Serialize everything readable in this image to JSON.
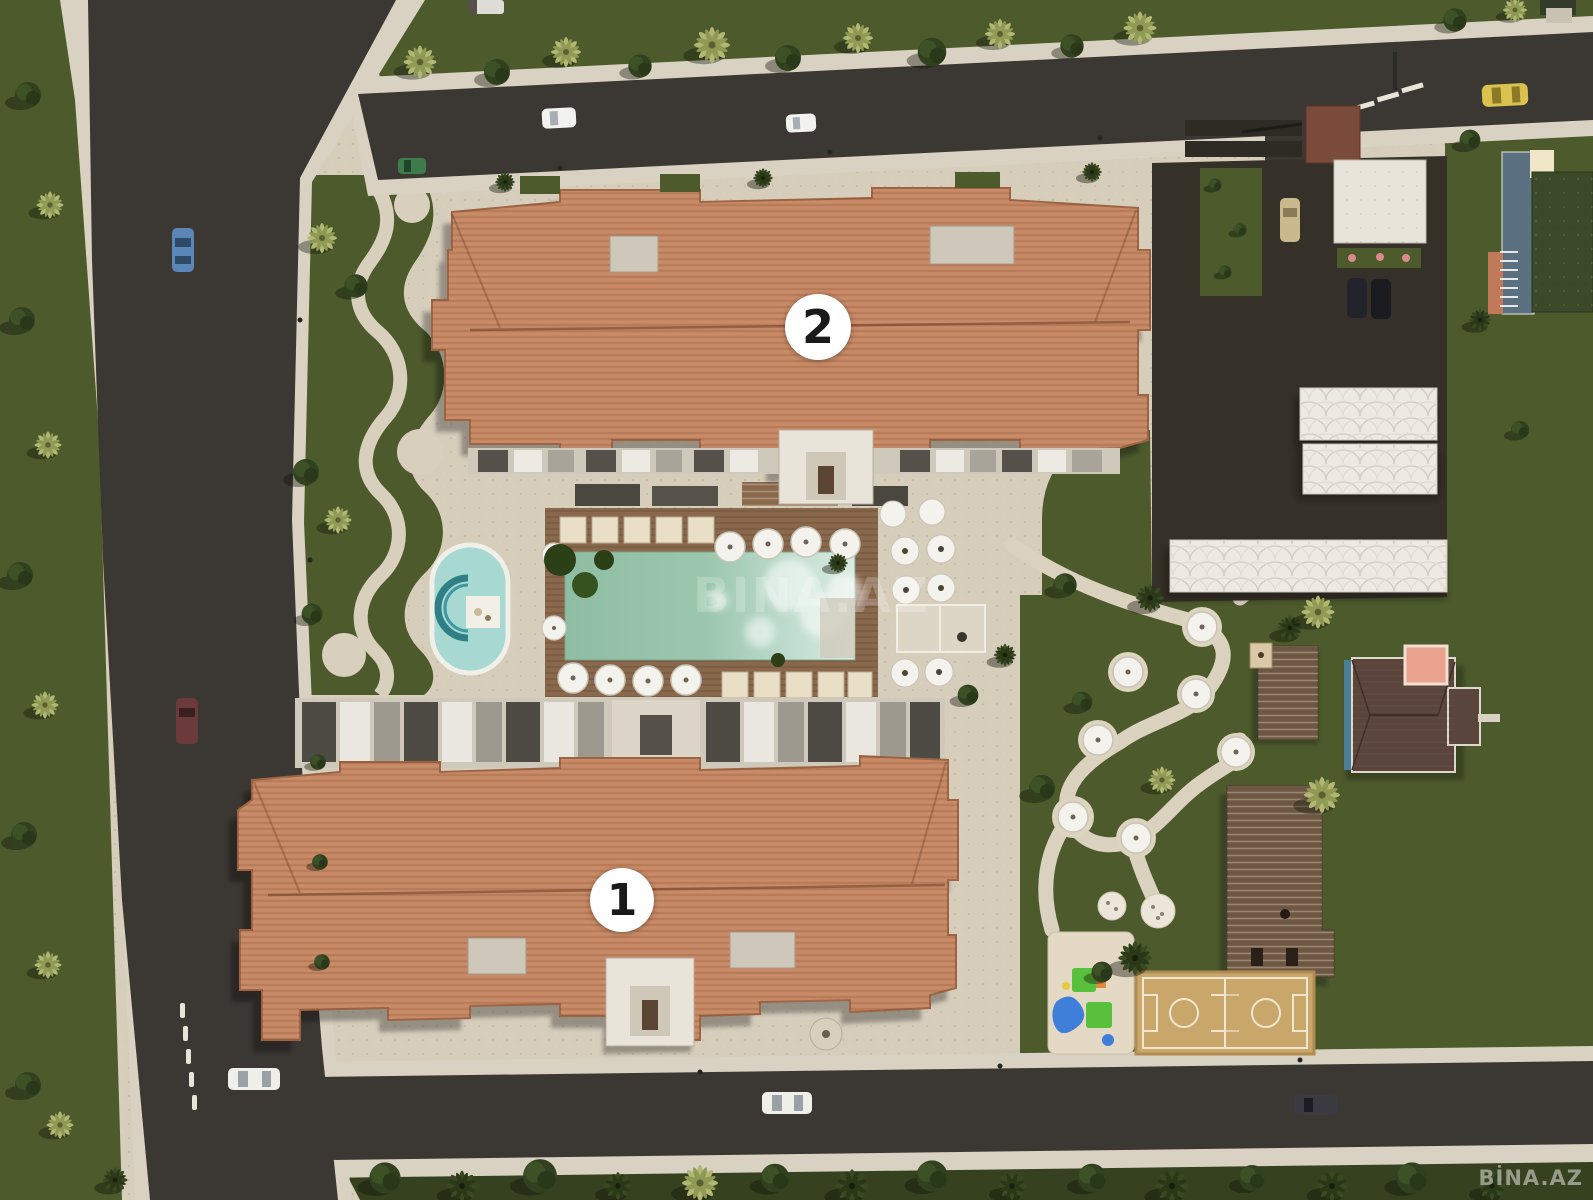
{
  "site_plan": {
    "title": "residential-complex-master-plan",
    "watermark_center": "BINA.AZ",
    "watermark_corner": "BİNA.AZ",
    "buildings": [
      {
        "id": "building-1",
        "label": "1"
      },
      {
        "id": "building-2",
        "label": "2"
      }
    ]
  },
  "palette": {
    "lawn": "#4c5a2c",
    "lawn-dark": "#36421f",
    "road": "#3b3733",
    "sidewalk": "#d9d2c2",
    "pavement": "#d6cdbb",
    "roof": "#c58763",
    "roof-dark": "#9c6443",
    "deck": "#8a684c",
    "pool": "#9cc3ab",
    "pool-light": "#dcebe2",
    "kids-pool": "#a7d8d2",
    "canopy": "#edeae4",
    "court": "#c9a76b",
    "pergola": "#6d5743",
    "marker-bg": "#ffffff",
    "marker-text": "#1a1a1a"
  }
}
